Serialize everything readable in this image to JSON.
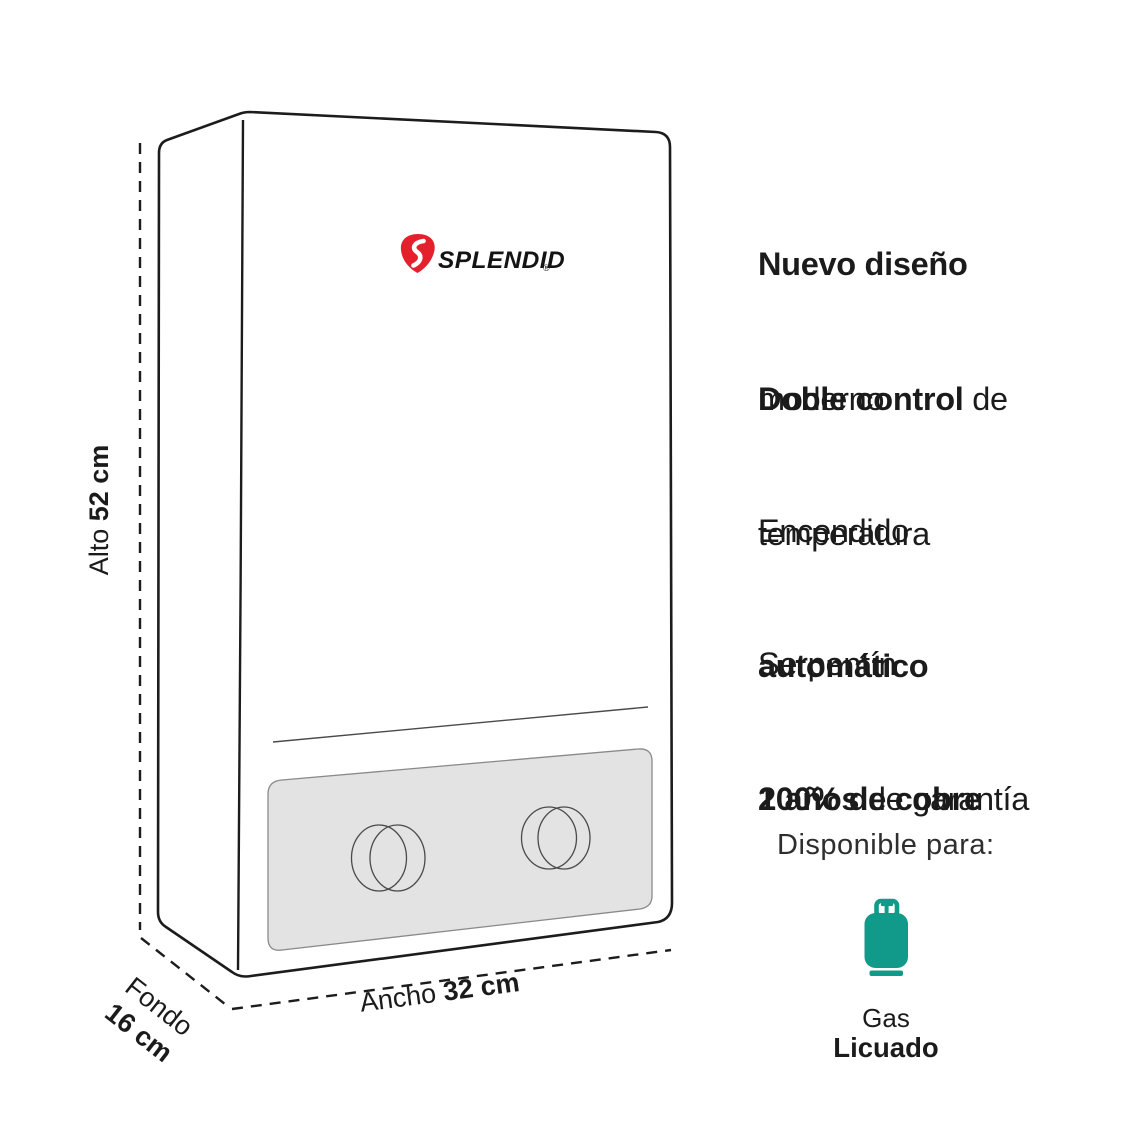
{
  "colors": {
    "accent_red": "#e4202c",
    "teal": "#119a89",
    "line": "#1c1c1c",
    "panel_gray": "#e3e3e3",
    "text": "#1b1b1b"
  },
  "logo": {
    "brand": "SPLENDID",
    "registered": "®"
  },
  "dimensions": {
    "alto": {
      "label": "Alto ",
      "value": "52 cm"
    },
    "fondo": {
      "label": "Fondo",
      "value": "16 cm"
    },
    "ancho": {
      "label": "Ancho ",
      "value": "32 cm"
    }
  },
  "features": [
    {
      "line1_bold": "Nuevo diseño",
      "line1_regular": "",
      "line2_bold": "",
      "line2_regular": "moderno"
    },
    {
      "line1_bold": "Doble control",
      "line1_regular": " de",
      "line2_bold": "",
      "line2_regular": "temperatura"
    },
    {
      "line1_bold": "",
      "line1_regular": "Encendido",
      "line2_bold": "automático",
      "line2_regular": ""
    },
    {
      "line1_bold": "",
      "line1_regular": "Serpentín",
      "line2_bold": "100% de cobre",
      "line2_regular": ""
    },
    {
      "line1_bold": "2 años",
      "line1_regular": " de garantía",
      "line2_bold": "",
      "line2_regular": ""
    }
  ],
  "availability": {
    "title": "Disponible para:",
    "fuel_line1": "Gas",
    "fuel_line2": "Licuado"
  }
}
